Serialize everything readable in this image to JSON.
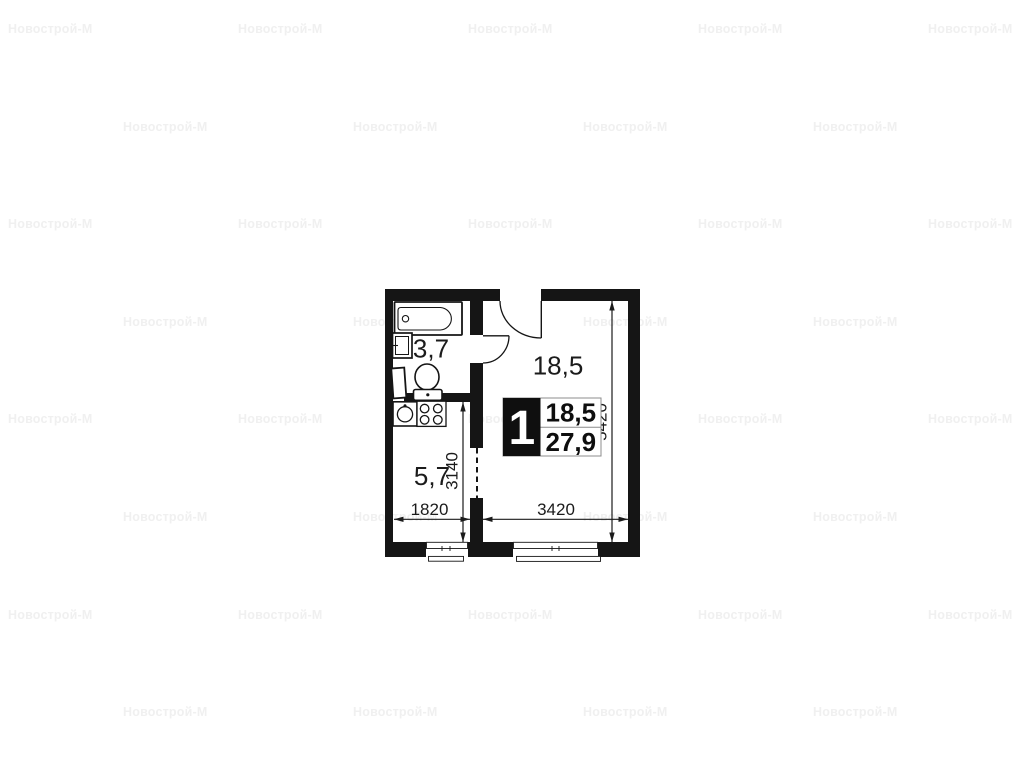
{
  "watermark": {
    "text": "Новострой-М",
    "color": "#f0f0f0"
  },
  "floor_plan": {
    "room_labels": {
      "bathroom": "3,7",
      "kitchen": "5,7",
      "living_room": "18,5"
    },
    "info_badge": {
      "rooms_count": "1",
      "living_area_m2": "18,5",
      "total_area_m2": "27,9"
    },
    "dimensions_mm": {
      "room_height": "5420",
      "kitchen_height": "3140",
      "kitchen_width": "1820",
      "room_width": "3420"
    },
    "colors": {
      "wall": "#151515",
      "dimension": "#1b1b1b",
      "badge_border": "#8c8c8c"
    }
  }
}
